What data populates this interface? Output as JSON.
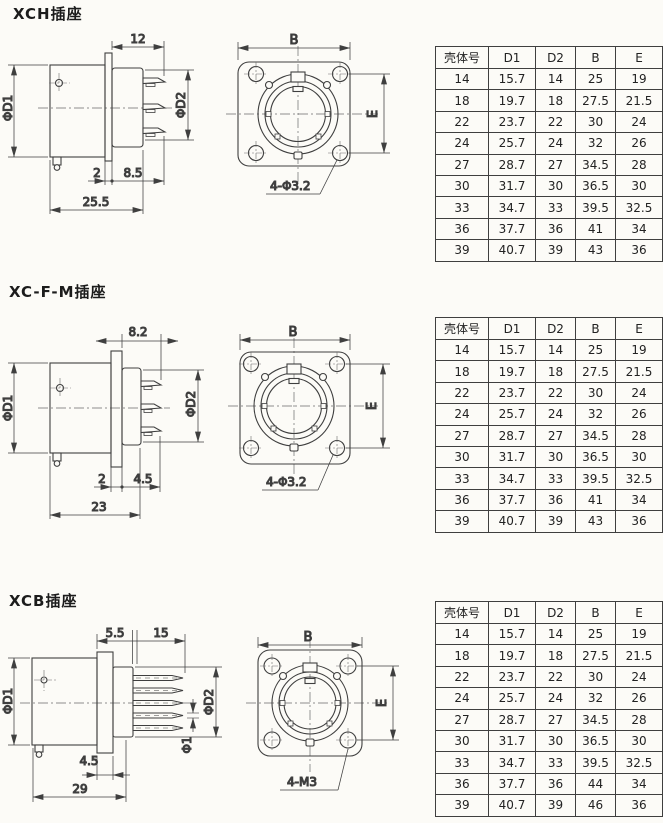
{
  "page": {
    "background": "#fcfbf7",
    "line_color": "#3f3f3f"
  },
  "sections": [
    {
      "title": "XCH插座",
      "side": {
        "top": "12",
        "left": "ΦD1",
        "right": "ΦD2",
        "a": "2",
        "b": "8.5",
        "total": "25.5"
      },
      "front": {
        "width": "B",
        "height": "E",
        "holes": "4-Φ3.2"
      },
      "table": {
        "headers": [
          "壳体号",
          "D1",
          "D2",
          "B",
          "E"
        ],
        "rows": [
          [
            "14",
            "15.7",
            "14",
            "25",
            "19"
          ],
          [
            "18",
            "19.7",
            "18",
            "27.5",
            "21.5"
          ],
          [
            "22",
            "23.7",
            "22",
            "30",
            "24"
          ],
          [
            "24",
            "25.7",
            "24",
            "32",
            "26"
          ],
          [
            "27",
            "28.7",
            "27",
            "34.5",
            "28"
          ],
          [
            "30",
            "31.7",
            "30",
            "36.5",
            "30"
          ],
          [
            "33",
            "34.7",
            "33",
            "39.5",
            "32.5"
          ],
          [
            "36",
            "37.7",
            "36",
            "41",
            "34"
          ],
          [
            "39",
            "40.7",
            "39",
            "43",
            "36"
          ]
        ]
      }
    },
    {
      "title": "XC-F-M插座",
      "side": {
        "top": "8.2",
        "left": "ΦD1",
        "right": "ΦD2",
        "a": "2",
        "b": "4.5",
        "total": "23"
      },
      "front": {
        "width": "B",
        "height": "E",
        "holes": "4-Φ3.2"
      },
      "table": {
        "headers": [
          "壳体号",
          "D1",
          "D2",
          "B",
          "E"
        ],
        "rows": [
          [
            "14",
            "15.7",
            "14",
            "25",
            "19"
          ],
          [
            "18",
            "19.7",
            "18",
            "27.5",
            "21.5"
          ],
          [
            "22",
            "23.7",
            "22",
            "30",
            "24"
          ],
          [
            "24",
            "25.7",
            "24",
            "32",
            "26"
          ],
          [
            "27",
            "28.7",
            "27",
            "34.5",
            "28"
          ],
          [
            "30",
            "31.7",
            "30",
            "36.5",
            "30"
          ],
          [
            "33",
            "34.7",
            "33",
            "39.5",
            "32.5"
          ],
          [
            "36",
            "37.7",
            "36",
            "41",
            "34"
          ],
          [
            "39",
            "40.7",
            "39",
            "43",
            "36"
          ]
        ]
      }
    },
    {
      "title": "XCB插座",
      "side": {
        "top_a": "5.5",
        "top_b": "15",
        "left": "ΦD1",
        "right": "ΦD2",
        "pin": "Φ1",
        "a": "4.5",
        "total": "29"
      },
      "front": {
        "width": "B",
        "height": "E",
        "holes": "4-M3"
      },
      "table": {
        "headers": [
          "壳体号",
          "D1",
          "D2",
          "B",
          "E"
        ],
        "rows": [
          [
            "14",
            "15.7",
            "14",
            "25",
            "19"
          ],
          [
            "18",
            "19.7",
            "18",
            "27.5",
            "21.5"
          ],
          [
            "22",
            "23.7",
            "22",
            "30",
            "24"
          ],
          [
            "24",
            "25.7",
            "24",
            "32",
            "26"
          ],
          [
            "27",
            "28.7",
            "27",
            "34.5",
            "28"
          ],
          [
            "30",
            "31.7",
            "30",
            "36.5",
            "30"
          ],
          [
            "33",
            "34.7",
            "33",
            "39.5",
            "32.5"
          ],
          [
            "36",
            "37.7",
            "36",
            "44",
            "34"
          ],
          [
            "39",
            "40.7",
            "39",
            "46",
            "36"
          ]
        ]
      }
    }
  ]
}
